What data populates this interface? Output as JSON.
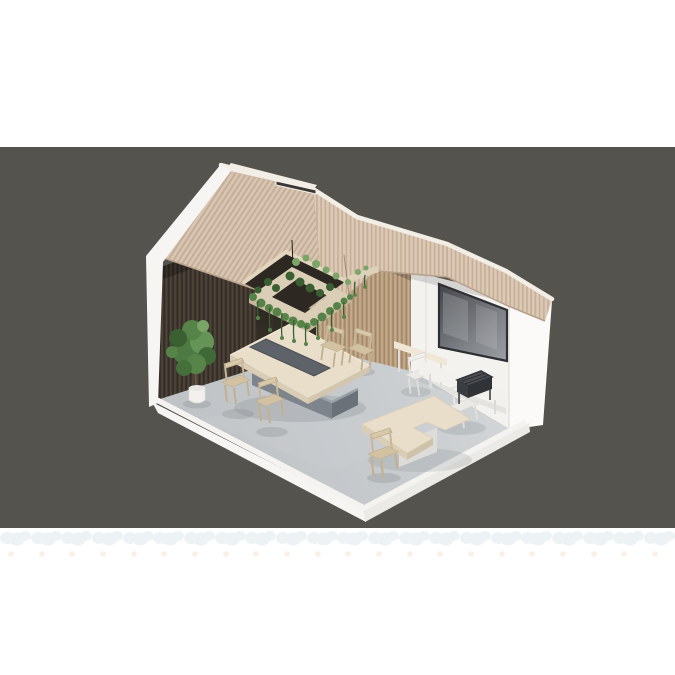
{
  "image": {
    "type": "3d-isometric-cutaway-render",
    "subject": "open-plan meeting / cafeteria room module with gabled slatted roof, wood slat walls, suspended planter with trailing greenery, conference table, media wall with large screen and loose chairs on a concrete floor slab",
    "width": 675,
    "height": 675
  },
  "palette": {
    "page": "#ffffff",
    "backdrop": "#55534d",
    "roof_base": "#d8c6b3",
    "eave_base": "#dccab6",
    "roof_rib": "#c3ad97",
    "ridge_cap": "#f2ede5",
    "skylight": "#3a3734",
    "wall_dark": "#463d34",
    "recess_dark": "#2b2521",
    "wall_tan": "#bca284",
    "wall_white": "#f4f2ef",
    "outer_wall": "#fbfaf8",
    "screen_frame": "#2e2f32",
    "screen_dark": "#46484d",
    "screen_light": "#9da0a3",
    "floor": "#c9cdd0",
    "slab": "#f6f5f3",
    "slab_side": "#eceae7",
    "table_top": "#e9dec9",
    "table_edge": "#d9cdb6",
    "table_inset": "#5d6368",
    "plinth": "#7e848b",
    "plinth_side": "#6b7178",
    "chair_wood": "#d9c9ab",
    "chair_white": "#f1efeb",
    "shelf": "#f0e7d6",
    "console": "#f3f1ee",
    "basket": "#4b4e53",
    "greenery": "#568348",
    "greenery_dark": "#3a5f31",
    "greenery_light": "#79a566",
    "pot": "#f2f1ee",
    "trunk": "#6a5741",
    "shadow": "#858b90",
    "watermark_blue": "#dfeaee",
    "watermark_warm": "#f2dfc6"
  },
  "scene": {
    "objects": [
      {
        "name": "backdrop-band",
        "color_ref": "backdrop"
      },
      {
        "name": "gabled-roof",
        "material": "ribbed timber slats",
        "color_ref": "roof_base"
      },
      {
        "name": "ridge-skylight",
        "color_ref": "skylight"
      },
      {
        "name": "roof-opening-planter",
        "color_ref": "greenery"
      },
      {
        "name": "slat-wall-dark",
        "color_ref": "wall_dark"
      },
      {
        "name": "slat-wall-tan",
        "color_ref": "wall_tan"
      },
      {
        "name": "media-wall",
        "color_ref": "wall_white"
      },
      {
        "name": "wall-screen",
        "color_ref": "screen_dark"
      },
      {
        "name": "exterior-end-wall",
        "color_ref": "outer_wall"
      },
      {
        "name": "concrete-floor",
        "color_ref": "floor"
      },
      {
        "name": "floor-slab-edge",
        "color_ref": "slab"
      },
      {
        "name": "conference-table",
        "color_ref": "table_top"
      },
      {
        "name": "table-planter-inset",
        "color_ref": "table_inset"
      },
      {
        "name": "dining-chairs-wood",
        "color_ref": "chair_wood"
      },
      {
        "name": "chairs-white",
        "color_ref": "chair_white"
      },
      {
        "name": "wall-shelf-bench",
        "color_ref": "shelf"
      },
      {
        "name": "media-console",
        "color_ref": "console"
      },
      {
        "name": "wire-basket-cart",
        "color_ref": "basket"
      },
      {
        "name": "l-shaped-table",
        "color_ref": "table_top"
      },
      {
        "name": "potted-fiddle-leaf-fig",
        "color_ref": "greenery"
      }
    ]
  },
  "watermark": {
    "rows": 2,
    "tile_pitch_px": 30.7,
    "tiles_per_row": 22
  }
}
